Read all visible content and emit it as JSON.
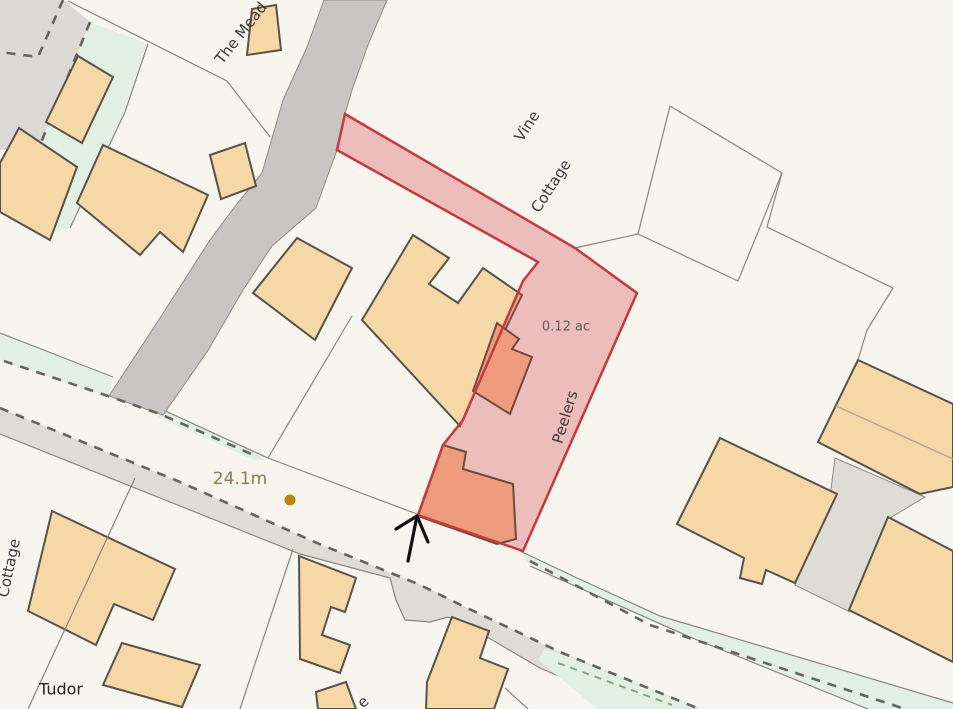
{
  "map": {
    "labels": {
      "the_mead": "The Mead",
      "vine_line1": "Vine",
      "vine_line2": "Cottage",
      "parcel_area": "0.12 ac",
      "parcel_name": "Peelers",
      "benchmark": "24.1m",
      "cottage_left": "Cottage",
      "tudor": "Tudor",
      "partial_label": "e"
    },
    "colors": {
      "background": "#f8f5ef",
      "building_fill": "#f6d7a6",
      "building_stroke": "#57524b",
      "parcel_fill": "rgba(210,60,62,0.30)",
      "parcel_stroke": "#c8393b",
      "parcel_building_fill": "#ee9c7d",
      "parcel_building_stroke": "#6f4a40",
      "road_fill": "#c8c5c2",
      "sidewalk_fill": "#dfdbd5",
      "verge_fill": "#e2efe3",
      "dash_line": "#66645f",
      "green_dash": "#84a884",
      "boundary_line": "#8b867d",
      "benchmark_color": "#96764a",
      "dot_color": "#b8860b",
      "label_color": "#3a3a3a",
      "area_color": "#5e5e5e"
    }
  }
}
